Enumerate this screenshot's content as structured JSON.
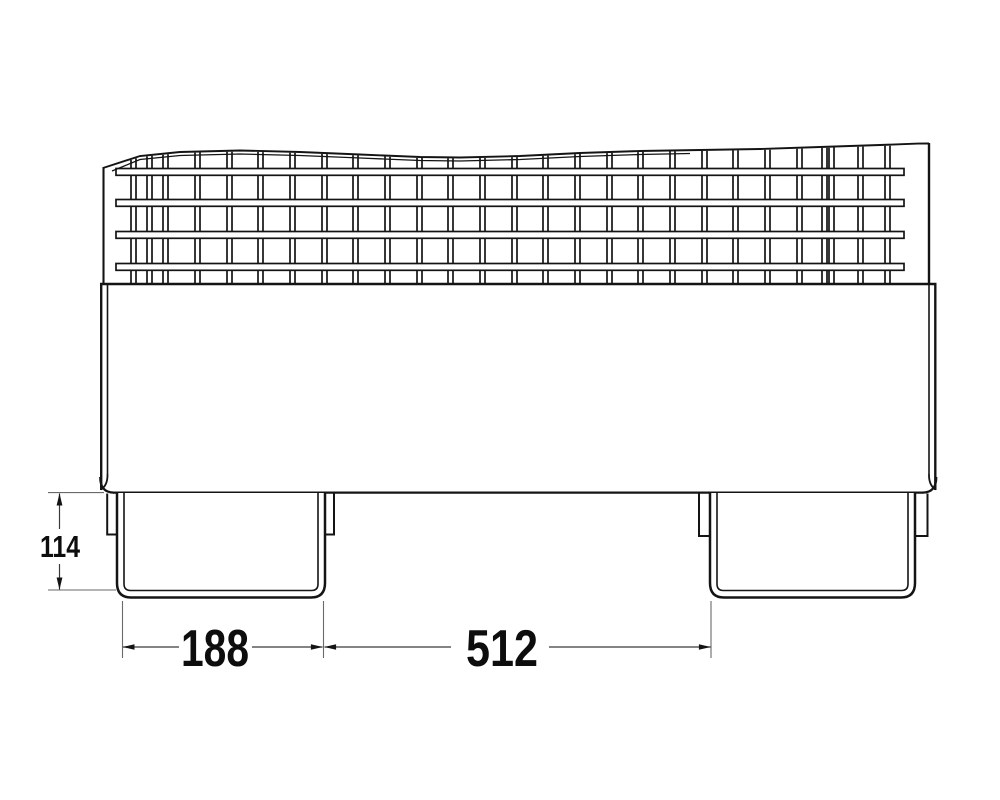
{
  "page": {
    "background": "#ffffff"
  },
  "drawing": {
    "kind": "technical-drawing-side-elevation",
    "subject": "mesh-box-pallet-with-channel-feet",
    "labels": {
      "height_dim": "114",
      "left_foot_width_dim": "188",
      "feet_spacing_dim": "512"
    },
    "colors": {
      "stroke": "#141414",
      "dimension_line": "#3a3a3a",
      "extension_line": "#6a6a6a",
      "text": "#0d0d0d",
      "background": "#ffffff"
    }
  }
}
